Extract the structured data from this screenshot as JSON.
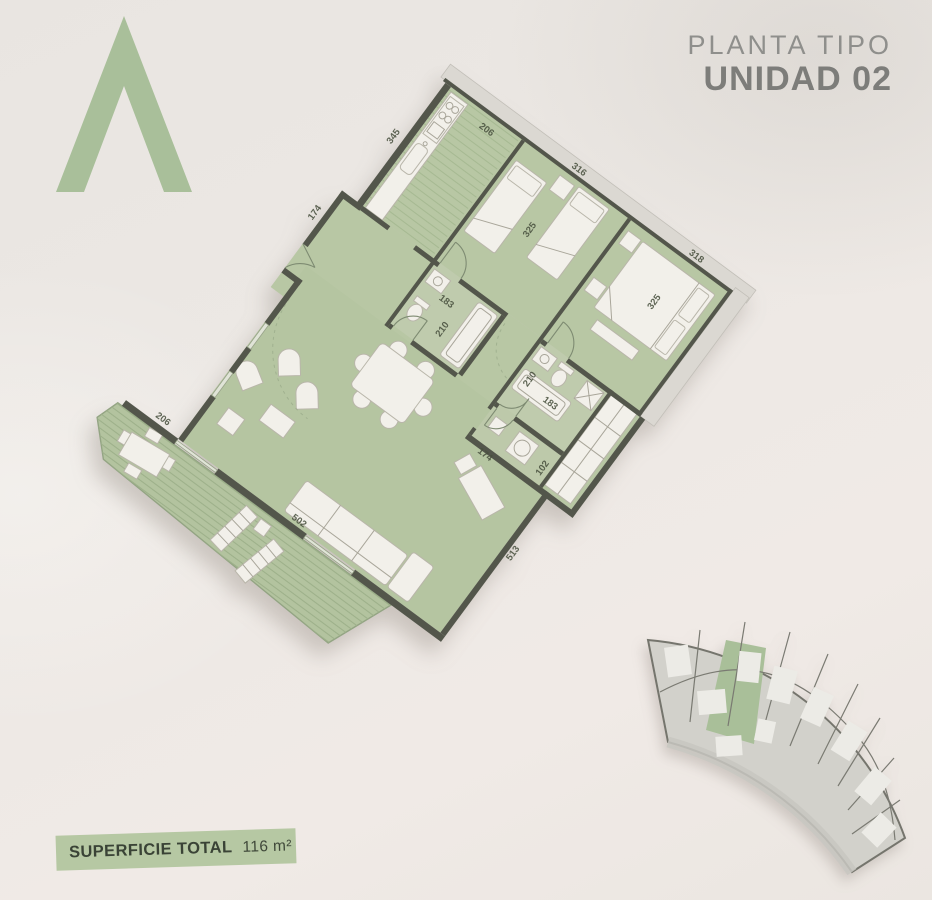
{
  "header": {
    "title_line1": "PLANTA TIPO",
    "title_line2": "UNIDAD 02"
  },
  "plan": {
    "labels": {
      "kitchen_345": "345",
      "kitchen_206": "206",
      "bedroom1_316": "316",
      "bedroom1_325": "325",
      "bedroom2_318": "318",
      "bedroom2_325": "325",
      "bathroom1_183": "183",
      "bathroom1_210": "210",
      "entry_174": "174",
      "bathroom2_210": "210",
      "bathroom2_183": "183",
      "laundry_174": "174",
      "laundry_102": "102",
      "living_513": "513",
      "living_502": "502",
      "terrace_206": "206"
    }
  },
  "footer": {
    "surface_label": "SUPERFICIE TOTAL",
    "surface_value": "116 m²"
  },
  "colors": {
    "plan_green": "#b8c7a4",
    "logo_green": "#a9bf9a",
    "banner_green": "#b6c8a3",
    "wall_dark": "#53564b",
    "background": "#ebe7e2",
    "title_gray": "#8a8a88"
  }
}
